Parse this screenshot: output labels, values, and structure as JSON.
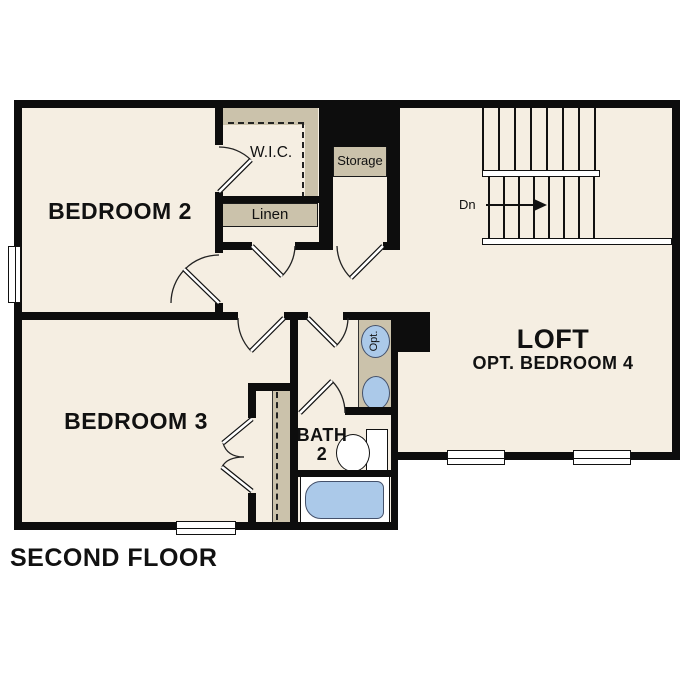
{
  "title": "SECOND FLOOR",
  "rooms": {
    "bedroom2": "BEDROOM 2",
    "bedroom3": "BEDROOM 3",
    "loft": "LOFT",
    "loft_option": "OPT. BEDROOM 4",
    "bath": "BATH",
    "bath_number": "2",
    "wic": "W.I.C.",
    "storage": "Storage",
    "linen": "Linen"
  },
  "stairs": {
    "direction_label": "Dn"
  },
  "fixtures": {
    "optional_sink": "Opt."
  },
  "colors": {
    "floor": "#f5eee2",
    "closet_shelf": "#cbc2ab",
    "fixture_blue": "#abc9e9",
    "wall": "#0d0d0d",
    "background": "#ffffff"
  }
}
